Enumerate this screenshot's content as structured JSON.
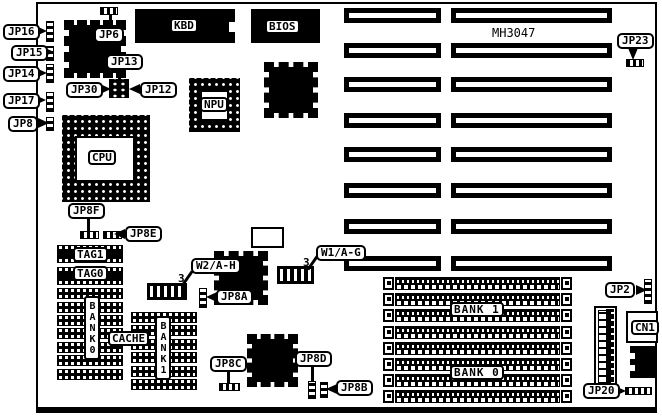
{
  "board": {
    "model": "MH3047"
  },
  "labels": {
    "jp16": "JP16",
    "jp15": "JP15",
    "jp14": "JP14",
    "jp17": "JP17",
    "jp8": "JP8",
    "jp6": "JP6",
    "jp13": "JP13",
    "jp30": "JP30",
    "jp12": "JP12",
    "kbd": "KBD",
    "bios": "BIOS",
    "cpu": "CPU",
    "npu": "NPU",
    "jp23": "JP23",
    "jp8f": "JP8F",
    "jp8e": "JP8E",
    "tag1": "TAG1",
    "tag0": "TAG0",
    "cache": "CACHE",
    "bank0_vertical": "BANK0",
    "bank1_vertical": "BANK1",
    "w2": "W2/A-H",
    "w2_pin": "3",
    "jp8a": "JP8A",
    "w1": "W1/A-G",
    "w1_pin": "3",
    "jp8c": "JP8C",
    "jp8d": "JP8D",
    "jp8b": "JP8B",
    "bank1": "BANK 1",
    "bank0": "BANK 0",
    "jp2": "JP2",
    "cn1": "CN1",
    "jp20": "JP20"
  }
}
